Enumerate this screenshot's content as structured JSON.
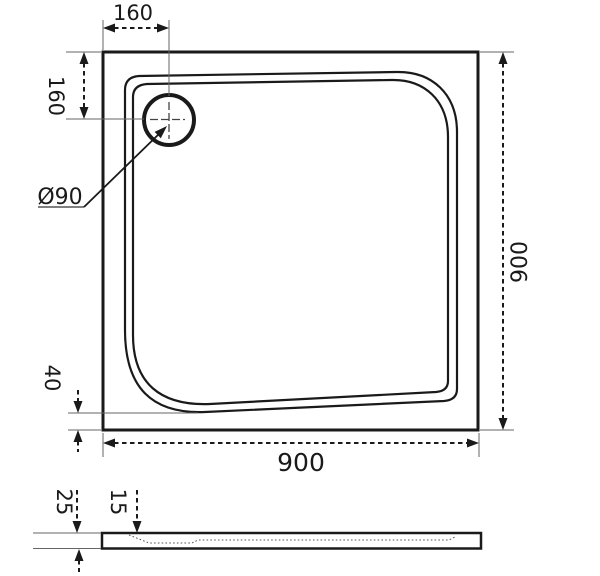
{
  "drawing": {
    "colors": {
      "background": "#ffffff",
      "main_line": "#1a1a1a",
      "thin_line": "#666666"
    },
    "top_view": {
      "dim_drain_offset_x": "160",
      "dim_drain_offset_y": "160",
      "dim_drain_diameter": "Ø90",
      "dim_overall_height": "900",
      "dim_bottom_inset": "40",
      "dim_overall_width": "900"
    },
    "side_view": {
      "dim_total_thickness": "25",
      "dim_inner_depth": "15"
    }
  }
}
